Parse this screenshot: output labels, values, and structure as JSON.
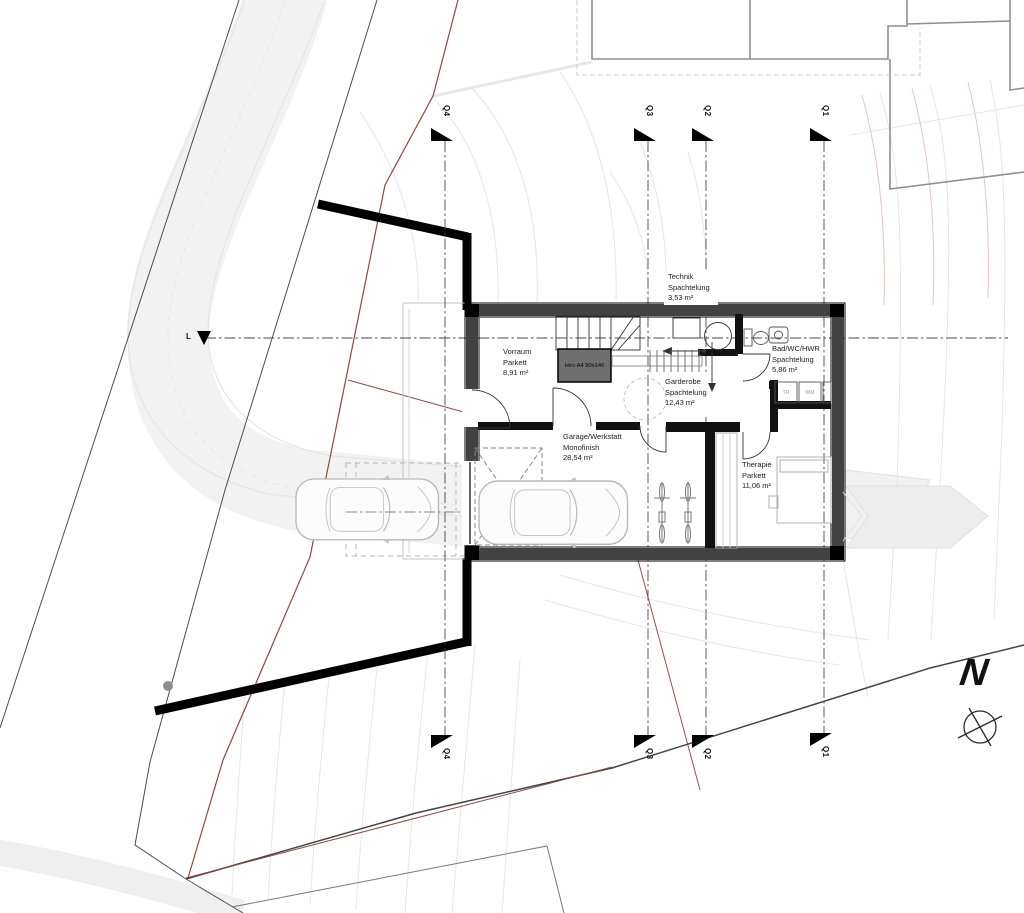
{
  "sections": {
    "q1": "Q1",
    "q2": "Q2",
    "q3": "Q3",
    "q4": "Q4",
    "l": "L"
  },
  "north": {
    "label": "N"
  },
  "rooms": {
    "technik": {
      "name": "Technik",
      "finish": "Spachtelung",
      "area": "3,53 m²"
    },
    "vorraum": {
      "name": "Vorraum",
      "finish": "Parkett",
      "area": "8,91 m²"
    },
    "garderobe": {
      "name": "Garderobe",
      "finish": "Spachtelung",
      "area": "12,43 m²"
    },
    "bad": {
      "name": "Bad/WC/HWR",
      "finish": "Spachtelung",
      "area": "5,86 m²"
    },
    "garage": {
      "name": "Garage/Werkstatt",
      "finish": "Monofinish",
      "area": "28,54 m²"
    },
    "therapie": {
      "name": "Therapie",
      "finish": "Parkett",
      "area": "11,06 m²"
    }
  },
  "equipment": {
    "lift": "Hiro A4 90x146",
    "dryer": "TR",
    "washer": "WM"
  },
  "colors": {
    "wall_band": "#424242",
    "partition": "#111111",
    "boundary_red": "#8d4a40",
    "road": "#f2f2f2",
    "contour": "#e6e6e6",
    "contour_red": "#e6c6bd"
  }
}
